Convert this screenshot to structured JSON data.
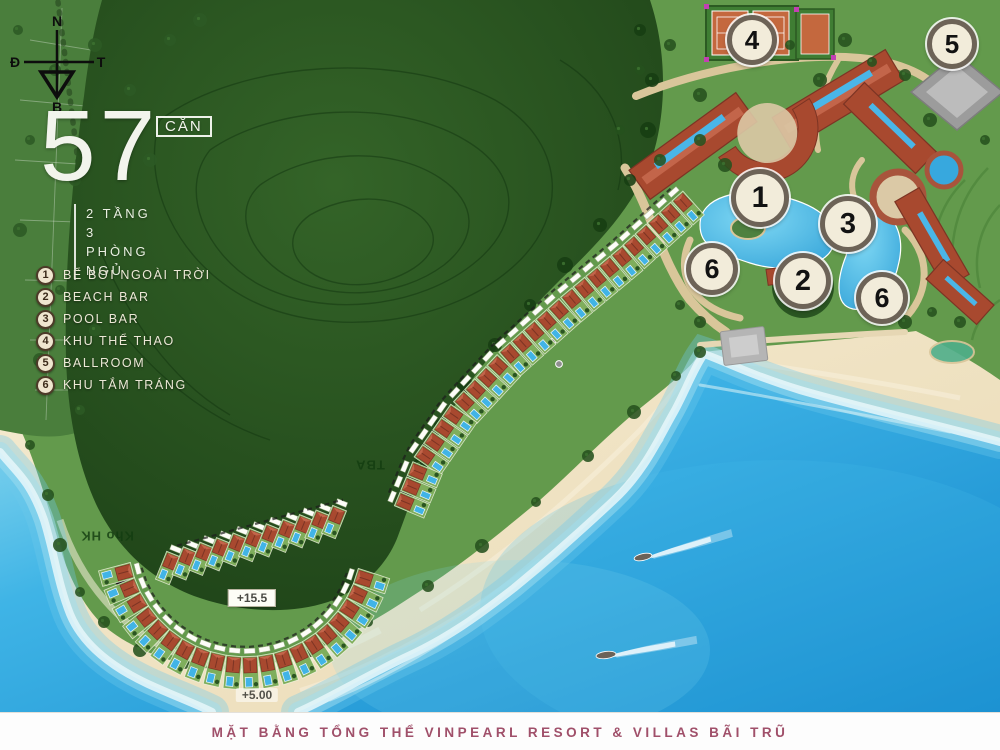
{
  "title_block": {
    "count": "57",
    "unit_label": "CĂN",
    "floors": "2 TẦNG",
    "bedrooms": "3 PHÒNG NGỦ"
  },
  "compass": {
    "top": "N",
    "bottom": "B",
    "left": "Đ",
    "right": "T"
  },
  "legend": [
    {
      "num": "1",
      "label": "BỂ BƠI NGOÀI TRỜI"
    },
    {
      "num": "2",
      "label": "BEACH BAR"
    },
    {
      "num": "3",
      "label": "POOL BAR"
    },
    {
      "num": "4",
      "label": "KHU THỂ THAO"
    },
    {
      "num": "5",
      "label": "BALLROOM"
    },
    {
      "num": "6",
      "label": "KHU TẮM TRÁNG"
    }
  ],
  "map_markers": [
    {
      "num": "4",
      "x": 752,
      "y": 40,
      "d": 50
    },
    {
      "num": "5",
      "x": 952,
      "y": 44,
      "d": 50
    },
    {
      "num": "1",
      "x": 760,
      "y": 198,
      "d": 58
    },
    {
      "num": "3",
      "x": 848,
      "y": 224,
      "d": 56
    },
    {
      "num": "6",
      "x": 712,
      "y": 269,
      "d": 52
    },
    {
      "num": "2",
      "x": 803,
      "y": 281,
      "d": 56
    },
    {
      "num": "6",
      "x": 882,
      "y": 298,
      "d": 52
    }
  ],
  "map_labels": [
    {
      "text": "+15.5",
      "x": 252,
      "y": 598,
      "style": "boxed"
    },
    {
      "text": "+5.00",
      "x": 257,
      "y": 695,
      "style": "plain"
    },
    {
      "text": "Kho HK",
      "x": 107,
      "y": 536,
      "style": "flipped"
    },
    {
      "text": "TBA",
      "x": 370,
      "y": 465,
      "style": "flipped"
    }
  ],
  "villas": {
    "total": 57,
    "rows": [
      {
        "type": "path",
        "points": [
          [
            688,
            208
          ],
          [
            628,
            262
          ],
          [
            568,
            312
          ],
          [
            512,
            362
          ],
          [
            462,
            416
          ],
          [
            430,
            462
          ],
          [
            412,
            505
          ]
        ],
        "count": 26,
        "size": [
          15,
          32
        ]
      },
      {
        "type": "line",
        "from": [
          168,
          568
        ],
        "to": [
          334,
          522
        ],
        "count": 11,
        "angle": 22,
        "size": [
          15,
          30
        ]
      },
      {
        "type": "arc",
        "cx": 245,
        "cy": 540,
        "r": 133,
        "a0": 165,
        "a1": 18,
        "count": 20,
        "size": [
          16,
          33
        ]
      }
    ]
  },
  "footer": {
    "caption": "MẶT BẰNG TỔNG THỂ VINPEARL RESORT & VILLAS BÃI TRŨ"
  },
  "colors": {
    "mountain": "#2a5622",
    "resort_green": "#639a4c",
    "plots_green": "#4a7e3c",
    "sand": "#efe2c2",
    "sea_deep": "#1287cc",
    "sea_light": "#8fd9ee",
    "pool": "#41b4e6",
    "roof": "#a8492f",
    "path_tan": "#d9c69a",
    "marker_fill": "#f2ecda",
    "marker_border": "#6d6357",
    "caption_color": "#a0506a",
    "legend_text": "#ece8d6"
  }
}
